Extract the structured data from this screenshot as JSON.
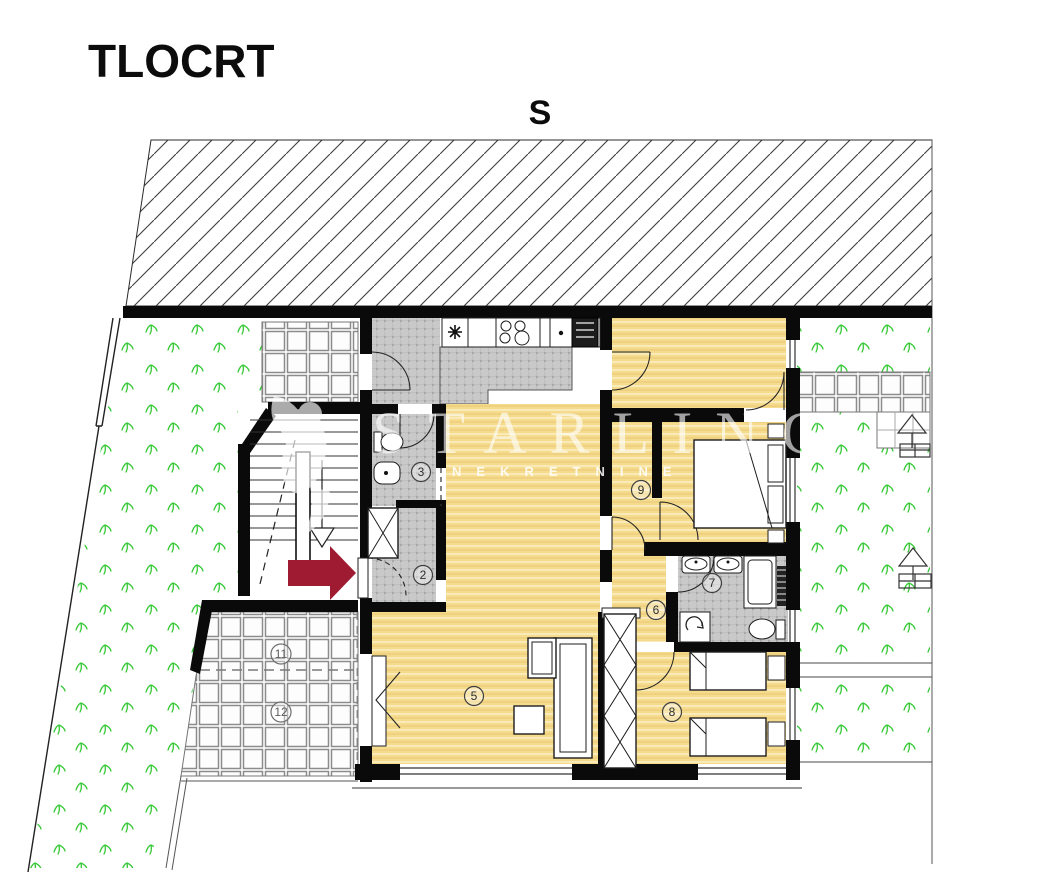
{
  "page": {
    "title": "TLOCRT",
    "orientation_label": "S"
  },
  "watermark": {
    "brand": "STARLING",
    "subtitle": "NEKRETNINE"
  },
  "rooms": [
    {
      "key": "entry-hall",
      "label": "2"
    },
    {
      "key": "wc",
      "label": "3"
    },
    {
      "key": "living-room",
      "label": "5"
    },
    {
      "key": "hallway",
      "label": "6"
    },
    {
      "key": "bathroom",
      "label": "7"
    },
    {
      "key": "bedroom-south",
      "label": "8"
    },
    {
      "key": "bedroom-east",
      "label": "9"
    },
    {
      "key": "terrace-upper",
      "label": "11"
    },
    {
      "key": "terrace-lower",
      "label": "12"
    }
  ],
  "colors": {
    "floor_yellow": "#f5db8b",
    "tile_gray": "#c9c9c9",
    "terrace_white": "#ffffff",
    "wall_black": "#0a0a0a",
    "grass_green": "#35c835",
    "entrance_arrow_red": "#9e1b32",
    "watermark_white": "rgba(255,255,255,0.65)"
  }
}
